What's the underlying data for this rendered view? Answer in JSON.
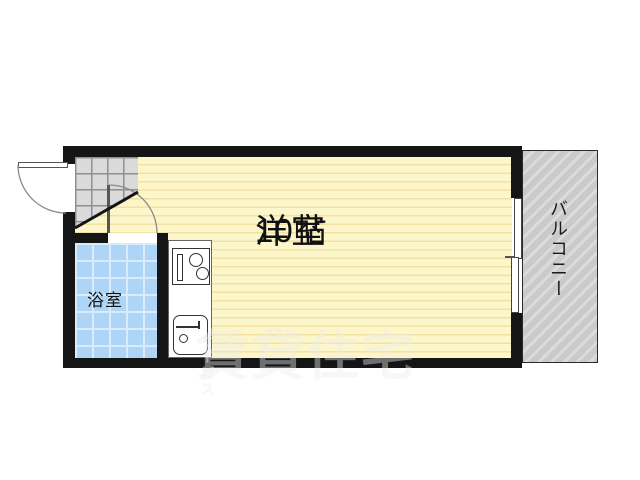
{
  "plan": {
    "rooms": {
      "main": {
        "name": "洋室",
        "size": "10帖"
      },
      "bathroom": {
        "name": "浴室"
      },
      "balcony": {
        "name": "バルコニー"
      }
    },
    "watermark": {
      "main": "賃貸住宅",
      "suffix": "サービス"
    }
  },
  "colors": {
    "wall": "#151515",
    "floor_base": "#FCF6CB",
    "floor_stripe": "#F5E0A3",
    "bath_tile": "#AED5F6",
    "bath_grid": "#D9EBFC",
    "genkan_tile": "#DADADA",
    "genkan_grid": "#8F8F8F",
    "balcony_base": "#CACACA",
    "balcony_stripe": "#DBDBDB"
  }
}
